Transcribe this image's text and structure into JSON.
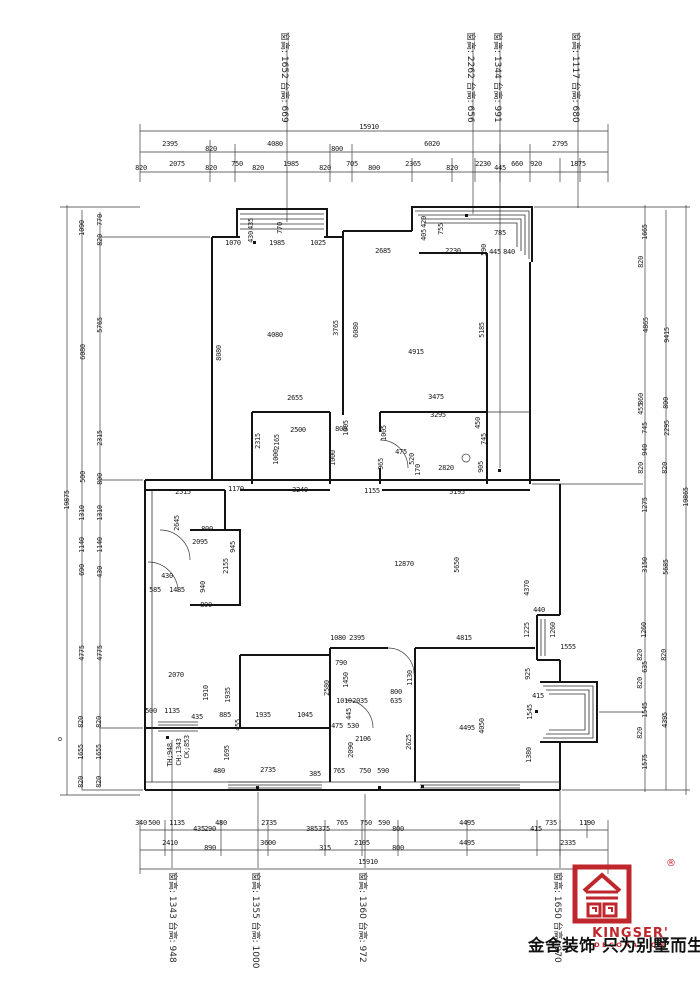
{
  "window_labels": {
    "top": [
      {
        "text": "窗高: 1652 台高: 669",
        "x": 287
      },
      {
        "text": "窗高: 2262 台高: 656",
        "x": 473
      },
      {
        "text": "窗高: 1344 台高: 991",
        "x": 500
      },
      {
        "text": "窗高: 1117 台高: 680",
        "x": 578
      }
    ],
    "bottom": [
      {
        "text": "窗高: 1343 台高: 948",
        "x": 175
      },
      {
        "text": "窗高: 1355 台高: 1000",
        "x": 258
      },
      {
        "text": "窗高: 1360 台高: 972",
        "x": 365
      },
      {
        "text": "窗高: 1650 台高: 970",
        "x": 560
      }
    ]
  },
  "logo": {
    "brand": "KINGSER'",
    "registered": "®",
    "sub": "DECORATION",
    "tagline": "金舍装饰 只为别墅而生。",
    "color": "#c0272d"
  },
  "dimensions": [
    {
      "t": "15910",
      "x": 369,
      "y": 127
    },
    {
      "t": "2395",
      "x": 170,
      "y": 144
    },
    {
      "t": "820",
      "x": 211,
      "y": 149
    },
    {
      "t": "4080",
      "x": 275,
      "y": 144
    },
    {
      "t": "800",
      "x": 337,
      "y": 149
    },
    {
      "t": "6020",
      "x": 432,
      "y": 144
    },
    {
      "t": "2795",
      "x": 560,
      "y": 144
    },
    {
      "t": "820",
      "x": 141,
      "y": 168
    },
    {
      "t": "2075",
      "x": 177,
      "y": 164
    },
    {
      "t": "820",
      "x": 211,
      "y": 168
    },
    {
      "t": "750",
      "x": 237,
      "y": 164
    },
    {
      "t": "820",
      "x": 258,
      "y": 168
    },
    {
      "t": "1985",
      "x": 291,
      "y": 164
    },
    {
      "t": "820",
      "x": 325,
      "y": 168
    },
    {
      "t": "705",
      "x": 352,
      "y": 164
    },
    {
      "t": "800",
      "x": 374,
      "y": 168
    },
    {
      "t": "2365",
      "x": 413,
      "y": 164
    },
    {
      "t": "820",
      "x": 452,
      "y": 168
    },
    {
      "t": "2230",
      "x": 483,
      "y": 164
    },
    {
      "t": "445",
      "x": 500,
      "y": 168
    },
    {
      "t": "660",
      "x": 517,
      "y": 164
    },
    {
      "t": "920",
      "x": 536,
      "y": 164
    },
    {
      "t": "1875",
      "x": 578,
      "y": 164
    },
    {
      "t": "340",
      "x": 141,
      "y": 823
    },
    {
      "t": "500",
      "x": 154,
      "y": 823
    },
    {
      "t": "1135",
      "x": 177,
      "y": 823
    },
    {
      "t": "435",
      "x": 199,
      "y": 829
    },
    {
      "t": "290",
      "x": 210,
      "y": 829
    },
    {
      "t": "480",
      "x": 221,
      "y": 823
    },
    {
      "t": "2735",
      "x": 269,
      "y": 823
    },
    {
      "t": "385",
      "x": 312,
      "y": 829
    },
    {
      "t": "375",
      "x": 324,
      "y": 829
    },
    {
      "t": "765",
      "x": 342,
      "y": 823
    },
    {
      "t": "750",
      "x": 366,
      "y": 823
    },
    {
      "t": "590",
      "x": 384,
      "y": 823
    },
    {
      "t": "800",
      "x": 398,
      "y": 829
    },
    {
      "t": "4495",
      "x": 467,
      "y": 823
    },
    {
      "t": "415",
      "x": 536,
      "y": 829
    },
    {
      "t": "735",
      "x": 551,
      "y": 823
    },
    {
      "t": "1190",
      "x": 587,
      "y": 823
    },
    {
      "t": "2410",
      "x": 170,
      "y": 843
    },
    {
      "t": "890",
      "x": 210,
      "y": 848
    },
    {
      "t": "3600",
      "x": 268,
      "y": 843
    },
    {
      "t": "315",
      "x": 325,
      "y": 848
    },
    {
      "t": "2105",
      "x": 362,
      "y": 843
    },
    {
      "t": "800",
      "x": 398,
      "y": 848
    },
    {
      "t": "4495",
      "x": 467,
      "y": 843
    },
    {
      "t": "2335",
      "x": 568,
      "y": 843
    },
    {
      "t": "15910",
      "x": 368,
      "y": 862
    },
    {
      "t": "19875",
      "x": 67,
      "y": 500,
      "r": 1
    },
    {
      "t": "1090",
      "x": 82,
      "y": 228,
      "r": 1
    },
    {
      "t": "770",
      "x": 100,
      "y": 220,
      "r": 1
    },
    {
      "t": "820",
      "x": 100,
      "y": 240,
      "r": 1
    },
    {
      "t": "5765",
      "x": 100,
      "y": 325,
      "r": 1
    },
    {
      "t": "6080",
      "x": 83,
      "y": 352,
      "r": 1
    },
    {
      "t": "2315",
      "x": 100,
      "y": 438,
      "r": 1
    },
    {
      "t": "500",
      "x": 83,
      "y": 477,
      "r": 1
    },
    {
      "t": "800",
      "x": 100,
      "y": 479,
      "r": 1
    },
    {
      "t": "1310",
      "x": 82,
      "y": 513,
      "r": 1
    },
    {
      "t": "1310",
      "x": 100,
      "y": 513,
      "r": 1
    },
    {
      "t": "1140",
      "x": 82,
      "y": 545,
      "r": 1
    },
    {
      "t": "1140",
      "x": 100,
      "y": 545,
      "r": 1
    },
    {
      "t": "690",
      "x": 82,
      "y": 570,
      "r": 1
    },
    {
      "t": "430",
      "x": 100,
      "y": 572,
      "r": 1
    },
    {
      "t": "4775",
      "x": 82,
      "y": 653,
      "r": 1
    },
    {
      "t": "4775",
      "x": 100,
      "y": 653,
      "r": 1
    },
    {
      "t": "820",
      "x": 81,
      "y": 722,
      "r": 1
    },
    {
      "t": "820",
      "x": 99,
      "y": 722,
      "r": 1
    },
    {
      "t": "1655",
      "x": 81,
      "y": 752,
      "r": 1
    },
    {
      "t": "1655",
      "x": 99,
      "y": 752,
      "r": 1
    },
    {
      "t": "820",
      "x": 81,
      "y": 782,
      "r": 1
    },
    {
      "t": "820",
      "x": 99,
      "y": 782,
      "r": 1
    },
    {
      "t": "19865",
      "x": 686,
      "y": 497,
      "r": 1
    },
    {
      "t": "1665",
      "x": 645,
      "y": 232,
      "r": 1
    },
    {
      "t": "820",
      "x": 641,
      "y": 262,
      "r": 1
    },
    {
      "t": "4865",
      "x": 646,
      "y": 325,
      "r": 1
    },
    {
      "t": "9415",
      "x": 667,
      "y": 335,
      "r": 1
    },
    {
      "t": "860",
      "x": 641,
      "y": 399,
      "r": 1
    },
    {
      "t": "455",
      "x": 641,
      "y": 409,
      "r": 1
    },
    {
      "t": "800",
      "x": 666,
      "y": 403,
      "r": 1
    },
    {
      "t": "745",
      "x": 645,
      "y": 428,
      "r": 1
    },
    {
      "t": "2295",
      "x": 667,
      "y": 428,
      "r": 1
    },
    {
      "t": "940",
      "x": 645,
      "y": 450,
      "r": 1
    },
    {
      "t": "820",
      "x": 641,
      "y": 468,
      "r": 1
    },
    {
      "t": "820",
      "x": 665,
      "y": 468,
      "r": 1
    },
    {
      "t": "1275",
      "x": 645,
      "y": 505,
      "r": 1
    },
    {
      "t": "3150",
      "x": 645,
      "y": 565,
      "r": 1
    },
    {
      "t": "5685",
      "x": 666,
      "y": 567,
      "r": 1
    },
    {
      "t": "1260",
      "x": 644,
      "y": 630,
      "r": 1
    },
    {
      "t": "820",
      "x": 640,
      "y": 655,
      "r": 1
    },
    {
      "t": "820",
      "x": 664,
      "y": 655,
      "r": 1
    },
    {
      "t": "635",
      "x": 645,
      "y": 667,
      "r": 1
    },
    {
      "t": "820",
      "x": 640,
      "y": 683,
      "r": 1
    },
    {
      "t": "1545",
      "x": 645,
      "y": 710,
      "r": 1
    },
    {
      "t": "4395",
      "x": 665,
      "y": 720,
      "r": 1
    },
    {
      "t": "820",
      "x": 640,
      "y": 733,
      "r": 1
    },
    {
      "t": "1575",
      "x": 645,
      "y": 762,
      "r": 1
    },
    {
      "t": "1070",
      "x": 233,
      "y": 243
    },
    {
      "t": "1985",
      "x": 277,
      "y": 243
    },
    {
      "t": "1025",
      "x": 318,
      "y": 243
    },
    {
      "t": "435",
      "x": 251,
      "y": 224,
      "r": 1
    },
    {
      "t": "430",
      "x": 251,
      "y": 237,
      "r": 1
    },
    {
      "t": "770",
      "x": 280,
      "y": 228,
      "r": 1
    },
    {
      "t": "4080",
      "x": 275,
      "y": 335
    },
    {
      "t": "3765",
      "x": 336,
      "y": 328,
      "r": 1
    },
    {
      "t": "8080",
      "x": 219,
      "y": 353,
      "r": 1
    },
    {
      "t": "2685",
      "x": 383,
      "y": 251
    },
    {
      "t": "2230",
      "x": 453,
      "y": 251
    },
    {
      "t": "755",
      "x": 441,
      "y": 229,
      "r": 1
    },
    {
      "t": "420",
      "x": 424,
      "y": 222,
      "r": 1
    },
    {
      "t": "405",
      "x": 424,
      "y": 235,
      "r": 1
    },
    {
      "t": "785",
      "x": 500,
      "y": 233
    },
    {
      "t": "590",
      "x": 484,
      "y": 250,
      "r": 1
    },
    {
      "t": "445",
      "x": 495,
      "y": 252
    },
    {
      "t": "840",
      "x": 509,
      "y": 252
    },
    {
      "t": "6080",
      "x": 356,
      "y": 330,
      "r": 1
    },
    {
      "t": "5185",
      "x": 482,
      "y": 330,
      "r": 1
    },
    {
      "t": "4915",
      "x": 416,
      "y": 352
    },
    {
      "t": "2655",
      "x": 295,
      "y": 398
    },
    {
      "t": "2500",
      "x": 298,
      "y": 430
    },
    {
      "t": "800",
      "x": 341,
      "y": 429
    },
    {
      "t": "2315",
      "x": 258,
      "y": 441,
      "r": 1
    },
    {
      "t": "2165",
      "x": 277,
      "y": 442,
      "r": 1
    },
    {
      "t": "1005",
      "x": 346,
      "y": 428,
      "r": 1
    },
    {
      "t": "1000",
      "x": 333,
      "y": 458,
      "r": 1
    },
    {
      "t": "1000",
      "x": 276,
      "y": 457,
      "r": 1
    },
    {
      "t": "3475",
      "x": 436,
      "y": 397
    },
    {
      "t": "3295",
      "x": 438,
      "y": 415
    },
    {
      "t": "475",
      "x": 401,
      "y": 452
    },
    {
      "t": "520",
      "x": 412,
      "y": 459,
      "r": 1
    },
    {
      "t": "170",
      "x": 418,
      "y": 470,
      "r": 1
    },
    {
      "t": "2820",
      "x": 446,
      "y": 468
    },
    {
      "t": "1005",
      "x": 384,
      "y": 433,
      "r": 1
    },
    {
      "t": "965",
      "x": 381,
      "y": 464,
      "r": 1
    },
    {
      "t": "450",
      "x": 478,
      "y": 423,
      "r": 1
    },
    {
      "t": "745",
      "x": 484,
      "y": 439,
      "r": 1
    },
    {
      "t": "905",
      "x": 481,
      "y": 467,
      "r": 1
    },
    {
      "t": "2515",
      "x": 183,
      "y": 492
    },
    {
      "t": "1170",
      "x": 236,
      "y": 489
    },
    {
      "t": "3240",
      "x": 300,
      "y": 490
    },
    {
      "t": "1155",
      "x": 372,
      "y": 491
    },
    {
      "t": "5195",
      "x": 457,
      "y": 492
    },
    {
      "t": "12870",
      "x": 404,
      "y": 564
    },
    {
      "t": "5650",
      "x": 457,
      "y": 565,
      "r": 1
    },
    {
      "t": "2645",
      "x": 177,
      "y": 523,
      "r": 1
    },
    {
      "t": "2095",
      "x": 200,
      "y": 542
    },
    {
      "t": "945",
      "x": 233,
      "y": 547,
      "r": 1
    },
    {
      "t": "800",
      "x": 207,
      "y": 529
    },
    {
      "t": "800",
      "x": 206,
      "y": 605
    },
    {
      "t": "585",
      "x": 155,
      "y": 590
    },
    {
      "t": "1485",
      "x": 177,
      "y": 590
    },
    {
      "t": "940",
      "x": 203,
      "y": 587,
      "r": 1
    },
    {
      "t": "430",
      "x": 167,
      "y": 576
    },
    {
      "t": "2155",
      "x": 226,
      "y": 566,
      "r": 1
    },
    {
      "t": "4370",
      "x": 527,
      "y": 588,
      "r": 1
    },
    {
      "t": "440",
      "x": 539,
      "y": 610
    },
    {
      "t": "1225",
      "x": 527,
      "y": 630,
      "r": 1
    },
    {
      "t": "1260",
      "x": 553,
      "y": 630,
      "r": 1
    },
    {
      "t": "1555",
      "x": 568,
      "y": 647
    },
    {
      "t": "1080",
      "x": 338,
      "y": 638
    },
    {
      "t": "2395",
      "x": 357,
      "y": 638
    },
    {
      "t": "4815",
      "x": 464,
      "y": 638
    },
    {
      "t": "790",
      "x": 341,
      "y": 663
    },
    {
      "t": "2070",
      "x": 176,
      "y": 675
    },
    {
      "t": "1910",
      "x": 206,
      "y": 693,
      "r": 1
    },
    {
      "t": "1935",
      "x": 228,
      "y": 695,
      "r": 1
    },
    {
      "t": "500",
      "x": 151,
      "y": 711
    },
    {
      "t": "1135",
      "x": 172,
      "y": 711
    },
    {
      "t": "435",
      "x": 197,
      "y": 717
    },
    {
      "t": "885",
      "x": 225,
      "y": 715
    },
    {
      "t": "1935",
      "x": 263,
      "y": 715
    },
    {
      "t": "1045",
      "x": 305,
      "y": 715
    },
    {
      "t": "455",
      "x": 238,
      "y": 725,
      "r": 1
    },
    {
      "t": "1695",
      "x": 227,
      "y": 753,
      "r": 1
    },
    {
      "t": "480",
      "x": 219,
      "y": 771
    },
    {
      "t": "2735",
      "x": 268,
      "y": 770
    },
    {
      "t": "385",
      "x": 315,
      "y": 774
    },
    {
      "t": "CK;853",
      "x": 187,
      "y": 747,
      "r": 1
    },
    {
      "t": "CH;1343",
      "x": 179,
      "y": 752,
      "r": 1
    },
    {
      "t": "TH;948",
      "x": 170,
      "y": 755,
      "r": 1
    },
    {
      "t": "1450",
      "x": 346,
      "y": 680,
      "r": 1
    },
    {
      "t": "2580",
      "x": 327,
      "y": 688,
      "r": 1
    },
    {
      "t": "1010",
      "x": 344,
      "y": 701
    },
    {
      "t": "2035",
      "x": 360,
      "y": 701
    },
    {
      "t": "800",
      "x": 396,
      "y": 692
    },
    {
      "t": "635",
      "x": 396,
      "y": 701
    },
    {
      "t": "1130",
      "x": 410,
      "y": 678,
      "r": 1
    },
    {
      "t": "475",
      "x": 337,
      "y": 726
    },
    {
      "t": "530",
      "x": 353,
      "y": 726
    },
    {
      "t": "445",
      "x": 349,
      "y": 714,
      "r": 1
    },
    {
      "t": "2106",
      "x": 363,
      "y": 739
    },
    {
      "t": "2090",
      "x": 351,
      "y": 750,
      "r": 1
    },
    {
      "t": "2625",
      "x": 409,
      "y": 742,
      "r": 1
    },
    {
      "t": "4495",
      "x": 467,
      "y": 728
    },
    {
      "t": "4050",
      "x": 482,
      "y": 726,
      "r": 1
    },
    {
      "t": "765",
      "x": 339,
      "y": 771
    },
    {
      "t": "750",
      "x": 365,
      "y": 771
    },
    {
      "t": "590",
      "x": 383,
      "y": 771
    },
    {
      "t": "925",
      "x": 528,
      "y": 674,
      "r": 1
    },
    {
      "t": "415",
      "x": 538,
      "y": 696
    },
    {
      "t": "1545",
      "x": 530,
      "y": 712,
      "r": 1
    },
    {
      "t": "1380",
      "x": 529,
      "y": 755,
      "r": 1
    }
  ]
}
